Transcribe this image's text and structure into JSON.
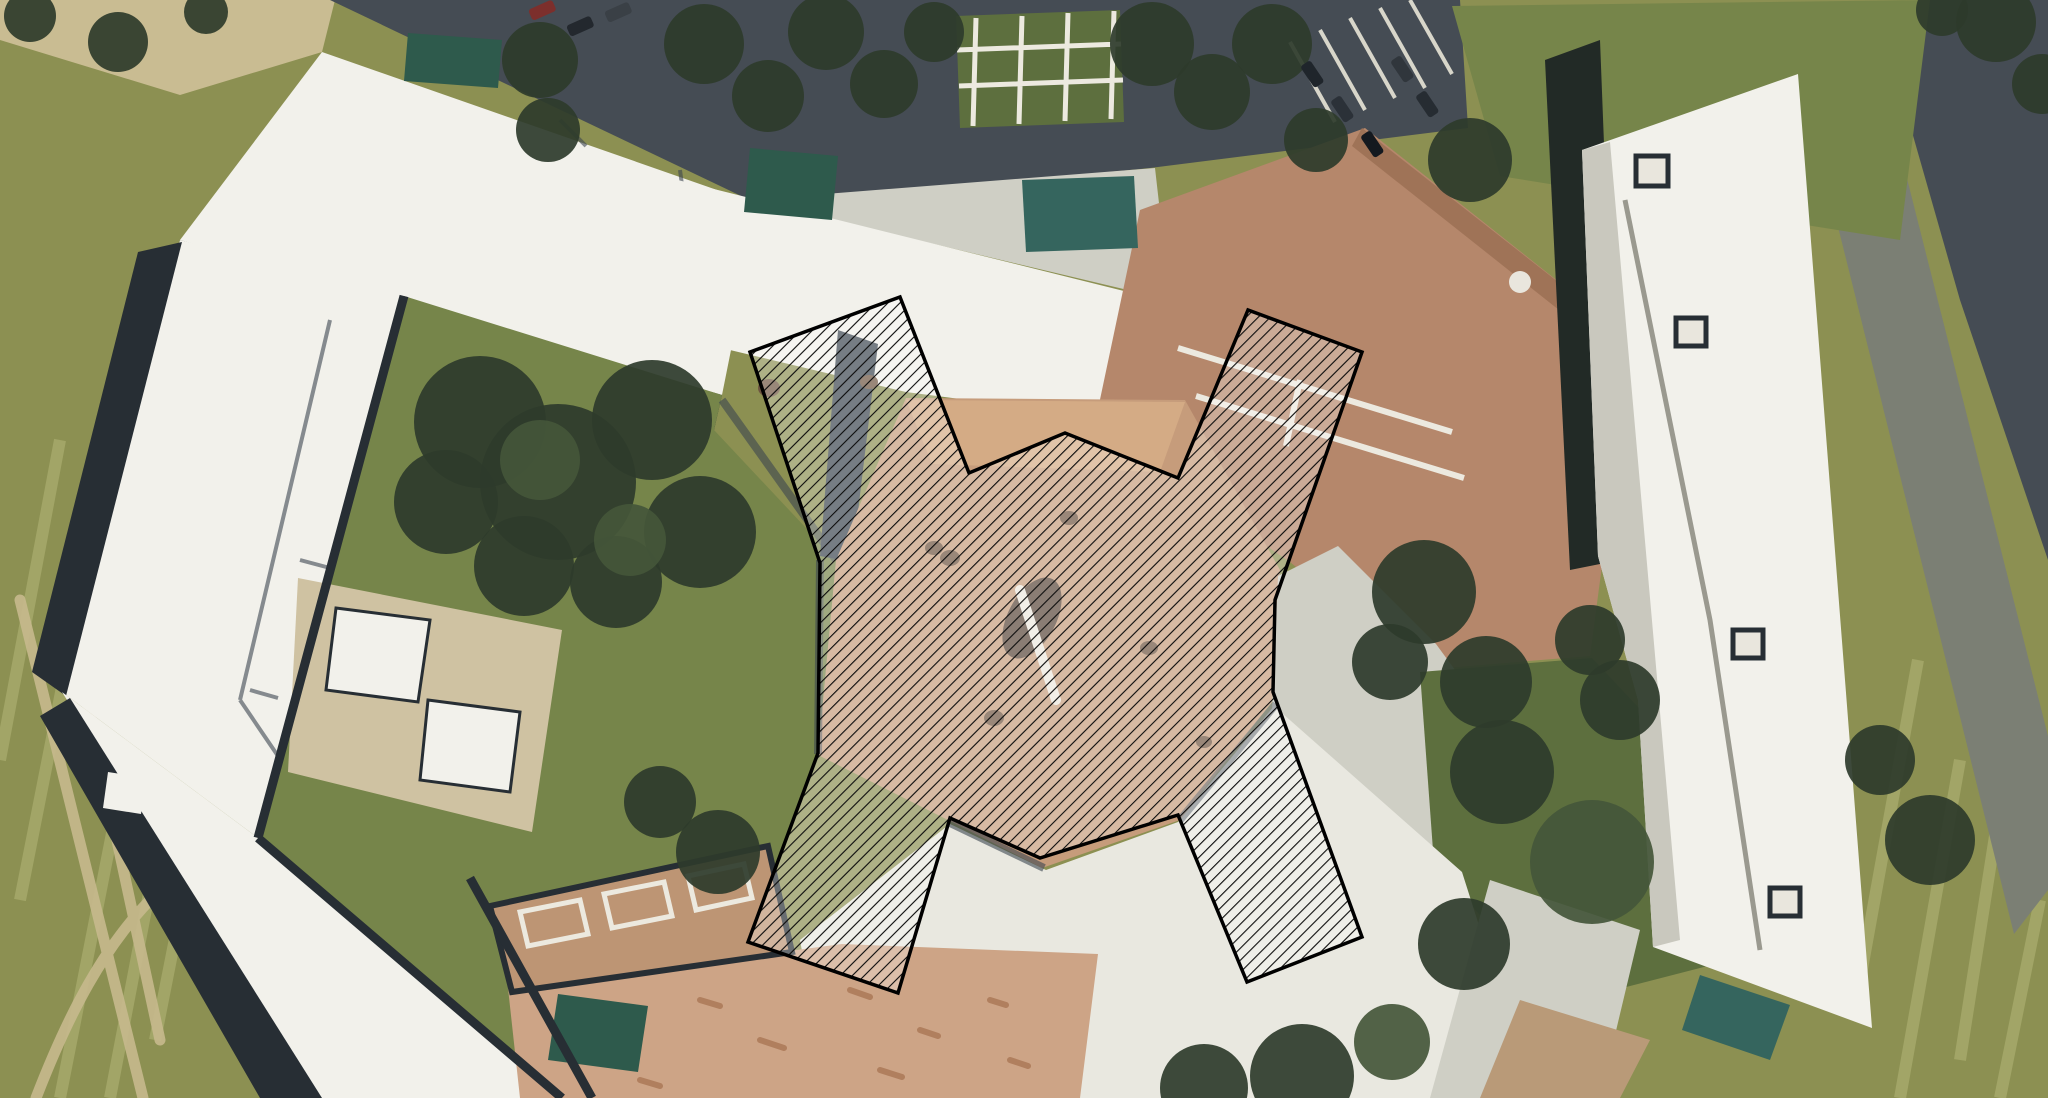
{
  "scene": {
    "canvas": {
      "width": 2048,
      "height": 1098,
      "viewbox": "0 0 2048 1098"
    },
    "colors": {
      "grass": "#8c9052",
      "stripe": "rgba(188,190,128,0.45)",
      "lawn": "#76854a",
      "lawn_dark": "#5d6f3e",
      "tree_dark": "#2e3b2b",
      "tree_mid": "#44563a",
      "asphalt": "#454c54",
      "road_gray": "#7b7f74",
      "concrete": "#cfcfc5",
      "concrete_bright": "#e9e8e0",
      "roof_white": "#f2f1eb",
      "roof_shade": "#c9c8be",
      "edge_dark": "#272e34",
      "shadow_blue": "#3c4650",
      "roof_brown": "#b5876b",
      "roof_brown_dark": "#9f7357",
      "plaza_brown": "#c69c7b",
      "plaza_brown_light": "#d4ab85",
      "dirt_salmon": "#cda486",
      "dirt_dark": "#b99a78",
      "speckle_brown": "#b07f5e",
      "trim_white": "#ece9df",
      "tan_building": "#bd9574",
      "patio_tan": "#cfc2a2",
      "canopy_teal": "#2e5a4c",
      "pool_teal": "#35655e",
      "path_tan": "#c6b98c",
      "tan_corner": "#c9bc92",
      "seam_gray": "#9a998f",
      "mark_dark": "#584538",
      "mark_small": "#6d5440",
      "dome_white": "#e9e6dd",
      "dark_trees_band": "#222a26",
      "stall_white": "#d8d6ca"
    },
    "ground": {
      "base_points": "0,0 2048,0 2048,1098 0,1098",
      "stripes_path": "M60,1098 L150,640 M110,1098 L205,600 M20,900 L95,520 M155,1040 L230,660 M0,760 L60,440 M1900,1098 L1960,760 M1960,1060 L2010,740 M1860,980 L1918,660 M2000,1098 L2040,900",
      "paths_d": "M20,600 L143,1098 M83,683 L160,1040 M36,1098 C70,1010 104,948 150,900",
      "tan_corner_points": "0,0 335,0 322,52 180,95 0,40"
    },
    "roads": {
      "top_band_points": "330,0 1460,0 1468,128 1150,168 760,205",
      "corner_road_points": "1930,0 2048,0 2048,560 1960,300 1900,90",
      "right_road_points": "1800,74 1874,48 2048,736 2048,890 2014,934",
      "stall_lines_path": "M1290,42 L1335,122 M1320,30 L1365,110 M1350,18 L1395,98 M1380,8 L1425,88 M1410,0 L1452,74"
    },
    "plazas": {
      "top_concrete_points": "558,215 1155,168 1170,300 580,160",
      "grid_lawn_points": "956,16 1120,10 1124,122 960,128",
      "grid_lines_path": "M976,18 L973,126 M1022,16 L1019,124 M1068,13 L1065,121 M1114,11 L1111,119 M957,50 L1121,44 M959,86 L1123,80",
      "bottom_white_points": "800,940 950,824 1046,870 1178,822 1274,706 1462,872 1504,1004 1312,1098 828,1098",
      "bottom_right_white_points": "1240,934 1402,982 1532,1042 1502,1098 1262,1098",
      "right_concrete_points": "1278,576 1338,546 1436,644 1524,764 1472,884 1272,710",
      "se_concrete_points": "1490,880 1640,930 1600,1098 1430,1098",
      "se_dirt_points": "1520,1000 1650,1040 1620,1098 1480,1098",
      "dirt_points": "508,988 842,944 1098,954 1080,1098 520,1098",
      "dirt_speckles_path": "M560,1020 l18,6 M610,1050 l22,8 M700,1000 l20,6 M760,1040 l24,8 M850,990 l20,7 M920,1030 l18,6 M990,1000 l16,5 M640,1080 l20,6 M880,1070 l22,7 M1010,1060 l18,6"
    },
    "buildings": {
      "left_top_wing_points": "322,52 760,205 722,395 180,240",
      "left_top_wing_band_points": "180,240 722,395 714,430 172,275",
      "left_west_wing_points": "180,240 404,296 258,838 62,692",
      "left_west_band_points": "138,252 182,242 66,696 32,672",
      "left_south_wing_points": "62,692 258,838 564,1098 316,1098",
      "left_south_band_points": "40,716 70,698 322,1098 260,1098",
      "left_roof_marks_path": "M330,320 L240,700 M240,700 L430,980 M300,560 l30,8 M250,690 l28,8 M560,120 l26,26 M680,170 l8,60 l-40,14",
      "center_north_slab_points": "577,155 1160,300 1122,420 906,392 646,330 557,218",
      "center_gap_band_points": "838,330 878,344 852,562 820,556",
      "brown_main_points": "1140,210 1365,128 1632,340 1590,656 1420,670 1290,562 1094,428",
      "brown_ridge_points": "1362,128 1632,340 1612,352 1352,146",
      "brown_walkway_path": "M1178,348 L1452,432 M1196,396 L1464,478 M1300,380 L1286,446",
      "brown_dome": {
        "cx": 1520,
        "cy": 282,
        "r": 11
      },
      "dark_band_points": "1545,60 1600,40 1620,560 1570,570",
      "right_slab_points": "1582,150 1798,74 1872,1028 1653,947 1638,700 1598,556",
      "right_slab_shade_points": "1582,150 1610,142 1680,940 1653,947 1638,700 1598,556",
      "right_slab_seam_path": "M1625,200 L1710,620 L1760,950",
      "right_slab_vents_path": "M1636,156 h32 v30 h-32 z M1676,318 h30 v28 h-30 z M1733,630 h30 v28 h-30 z M1770,888 h30 v28 h-30 z",
      "south_tan_points": "490,906 768,846 792,952 512,992",
      "south_tan_trim_path": "M520,912 l60,-12 8,34 -60,12 z M604,894 l60,-12 8,34 -60,12 z M688,876 l56,-12 8,34 -56,12 z",
      "shed_a_points": "336,608 430,620 418,702 326,690",
      "shed_b_points": "428,700 520,712 510,792 420,780",
      "shed_small_points": "108,772 146,778 141,814 103,808",
      "canopy_shelter_points": "408,33 502,40 498,88 404,81",
      "canopy_north_points": "750,148 838,156 832,220 744,212",
      "canopy_pool_points": "1022,180 1134,176 1138,248 1026,252",
      "canopy_south_points": "558,994 648,1006 638,1072 548,1060",
      "canopy_se_points": "1700,975 1790,1005 1770,1060 1682,1030"
    },
    "courtyards": {
      "left_lawn_points": "404,296 722,395 714,430 836,560 820,754 748,942 562,1098 258,838",
      "patio_points": "298,578 562,630 532,832 288,772",
      "ne_lawn_points": "1452,6 1930,0 1900,240 1500,176",
      "right_lawn_points": "1420,672 1592,658 1714,788 1762,952 1560,1004 1434,864"
    },
    "plaza_center": {
      "points": "836,560 906,398 1185,400 1280,570 1272,702 1180,820 1042,868 948,820 818,755",
      "notch_points": "906,400 1185,402 1160,472 932,464",
      "marks_path": "M940,558 a10,8 0 1,0 20,0 a10,8 0 1,0 -20,0 M1060,518 a9,7 0 1,0 18,0 a9,7 0 1,0 -18,0 M984,718 a10,8 0 1,0 20,0 a10,8 0 1,0 -20,0 M1140,648 a9,7 0 1,0 18,0 a9,7 0 1,0 -18,0 M1196,742 a8,6 0 1,0 16,0 a8,6 0 1,0 -16,0 M758,388 a11,9 0 1,0 22,0 a11,9 0 1,0 -22,0 M860,382 a9,7 0 1,0 18,0 a9,7 0 1,0 -18,0 M925,548 a9,7 0 1,0 18,0 a9,7 0 1,0 -18,0",
      "center_mark": {
        "cx": 1032,
        "cy": 618,
        "rx": 24,
        "ry": 44,
        "rotate": "rotate(28 1032 618)"
      },
      "center_streak": {
        "x1": 1020,
        "y1": 590,
        "x2": 1056,
        "y2": 700
      }
    },
    "shadows": {
      "blue_path": "M820,560 L818,754 M948,822 L1044,868 M1180,820 L1276,704 M722,400 L836,560",
      "dark_path": "M470,878 L592,1098 M404,296 L258,838 M258,838 L562,1098"
    },
    "trees": [
      {
        "cx": 30,
        "cy": 16,
        "r": 26
      },
      {
        "cx": 118,
        "cy": 42,
        "r": 30
      },
      {
        "cx": 206,
        "cy": 12,
        "r": 22
      },
      {
        "cx": 540,
        "cy": 60,
        "r": 38
      },
      {
        "cx": 548,
        "cy": 130,
        "r": 32
      },
      {
        "cx": 704,
        "cy": 44,
        "r": 40
      },
      {
        "cx": 768,
        "cy": 96,
        "r": 36
      },
      {
        "cx": 826,
        "cy": 32,
        "r": 38
      },
      {
        "cx": 884,
        "cy": 84,
        "r": 34
      },
      {
        "cx": 934,
        "cy": 32,
        "r": 30
      },
      {
        "cx": 1152,
        "cy": 44,
        "r": 42
      },
      {
        "cx": 1212,
        "cy": 92,
        "r": 38
      },
      {
        "cx": 1272,
        "cy": 44,
        "r": 40
      },
      {
        "cx": 1316,
        "cy": 140,
        "r": 32
      },
      {
        "cx": 1470,
        "cy": 160,
        "r": 42
      },
      {
        "cx": 1996,
        "cy": 22,
        "r": 40
      },
      {
        "cx": 2042,
        "cy": 84,
        "r": 30
      },
      {
        "cx": 1942,
        "cy": 10,
        "r": 26
      },
      {
        "cx": 480,
        "cy": 422,
        "r": 66
      },
      {
        "cx": 558,
        "cy": 482,
        "r": 78
      },
      {
        "cx": 652,
        "cy": 420,
        "r": 60
      },
      {
        "cx": 700,
        "cy": 532,
        "r": 56
      },
      {
        "cx": 524,
        "cy": 566,
        "r": 50
      },
      {
        "cx": 616,
        "cy": 582,
        "r": 46
      },
      {
        "cx": 446,
        "cy": 502,
        "r": 52
      },
      {
        "cx": 540,
        "cy": 460,
        "r": 40,
        "c": "#44563a"
      },
      {
        "cx": 630,
        "cy": 540,
        "r": 36,
        "c": "#44563a"
      },
      {
        "cx": 718,
        "cy": 852,
        "r": 42
      },
      {
        "cx": 660,
        "cy": 802,
        "r": 36
      },
      {
        "cx": 1424,
        "cy": 592,
        "r": 52
      },
      {
        "cx": 1486,
        "cy": 682,
        "r": 46
      },
      {
        "cx": 1390,
        "cy": 662,
        "r": 38
      },
      {
        "cx": 1502,
        "cy": 772,
        "r": 52
      },
      {
        "cx": 1592,
        "cy": 862,
        "r": 62,
        "c": "#44563a"
      },
      {
        "cx": 1464,
        "cy": 944,
        "r": 46
      },
      {
        "cx": 1620,
        "cy": 700,
        "r": 40
      },
      {
        "cx": 1590,
        "cy": 640,
        "r": 35
      },
      {
        "cx": 1930,
        "cy": 840,
        "r": 45
      },
      {
        "cx": 1880,
        "cy": 760,
        "r": 35
      },
      {
        "cx": 1302,
        "cy": 1076,
        "r": 52
      },
      {
        "cx": 1204,
        "cy": 1088,
        "r": 44
      },
      {
        "cx": 1392,
        "cy": 1042,
        "r": 38,
        "c": "#44563a"
      }
    ],
    "cars": [
      {
        "x": 528,
        "y": 10,
        "w": 26,
        "h": 12,
        "rot": -24,
        "c": "#7c2f2c"
      },
      {
        "x": 566,
        "y": 26,
        "w": 26,
        "h": 12,
        "rot": -24,
        "c": "#23282e"
      },
      {
        "x": 604,
        "y": 12,
        "w": 26,
        "h": 12,
        "rot": -24,
        "c": "#3a4046"
      },
      {
        "x": 1310,
        "y": 60,
        "w": 26,
        "h": 12,
        "rot": 56,
        "c": "#1f252b"
      },
      {
        "x": 1340,
        "y": 95,
        "w": 26,
        "h": 12,
        "rot": 56,
        "c": "#2b3138"
      },
      {
        "x": 1370,
        "y": 130,
        "w": 26,
        "h": 12,
        "rot": 56,
        "c": "#14191f"
      },
      {
        "x": 1400,
        "y": 55,
        "w": 26,
        "h": 12,
        "rot": 56,
        "c": "#30363c"
      },
      {
        "x": 1425,
        "y": 90,
        "w": 26,
        "h": 12,
        "rot": 56,
        "c": "#262c32"
      }
    ],
    "overlay": {
      "polygon_points": "750,352 900,297 969,473 1065,433 1178,478 1248,310 1362,352 1275,600 1273,692 1362,937 1247,982 1178,815 1040,858 950,818 898,993 748,942 818,753 820,563",
      "fill_color": "rgba(255,255,255,0.30)",
      "hatch_spacing": 8.5,
      "hatch_transform": "rotate(45)",
      "hatch_line_color": "#0b0b0b",
      "hatch_line_width": 2.2,
      "outline_color": "#000000",
      "outline_width": 3.5
    }
  }
}
